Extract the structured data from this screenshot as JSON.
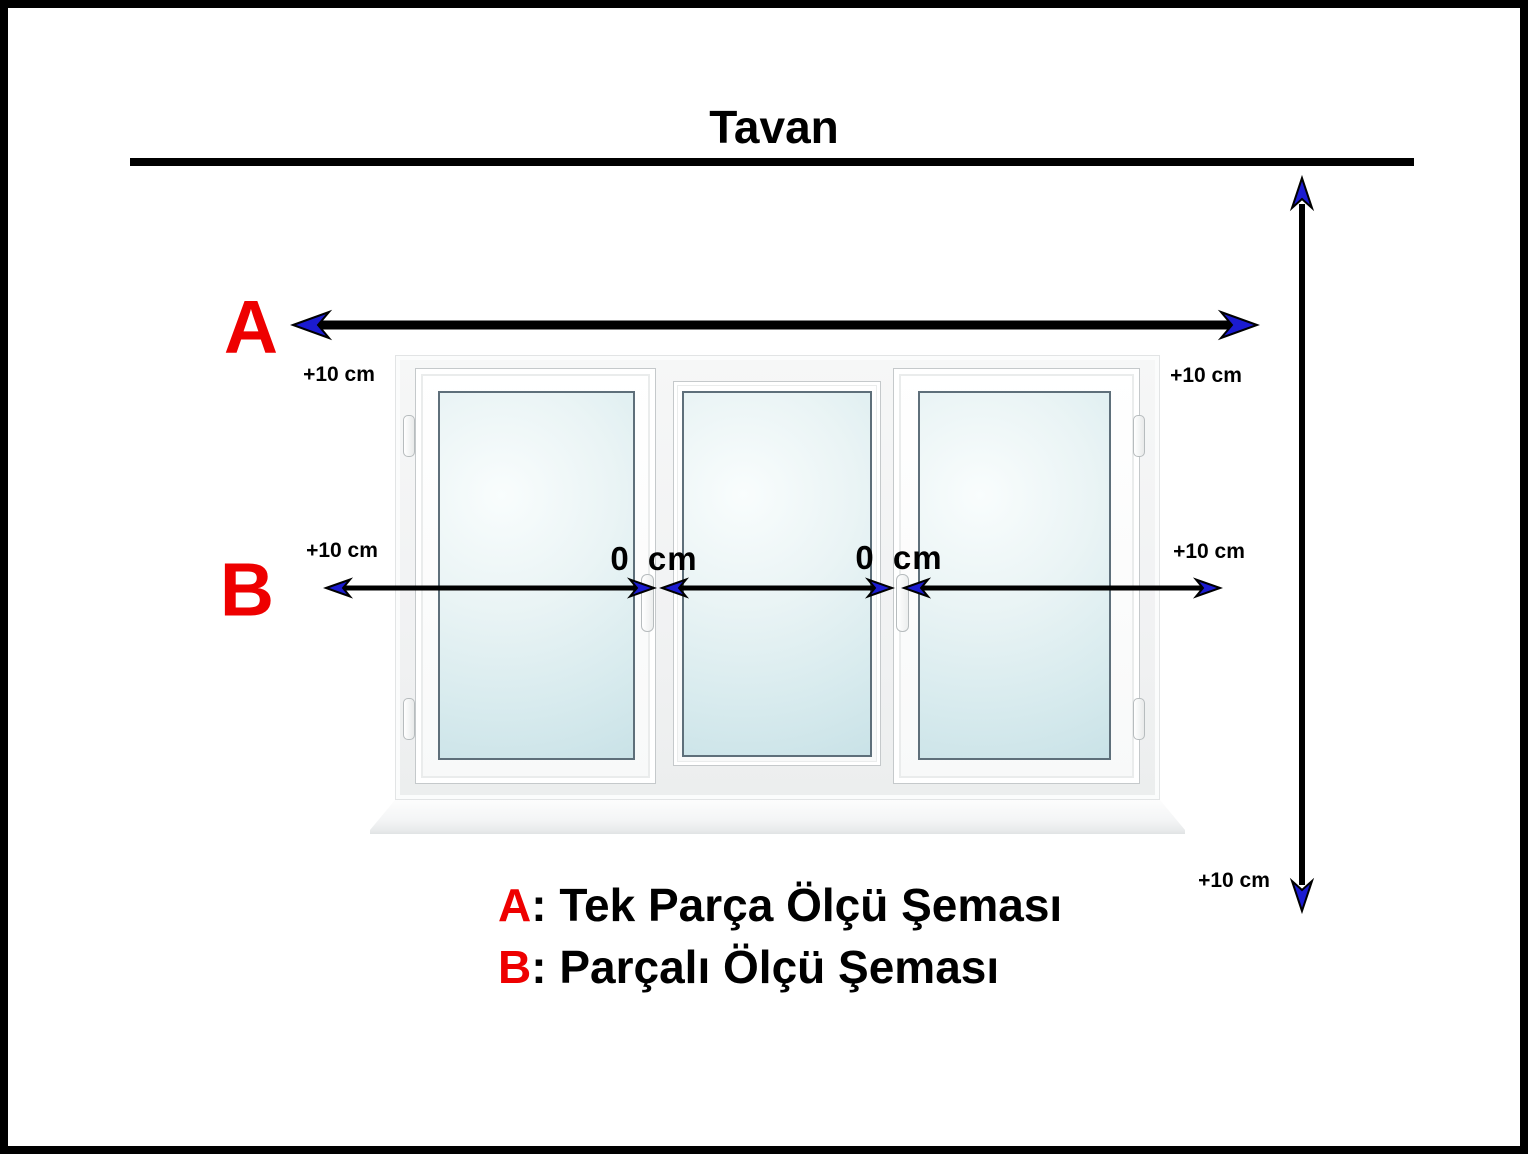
{
  "title": "Tavan",
  "schemas": {
    "a_letter": "A",
    "b_letter": "B"
  },
  "measurements": {
    "offset_label": "+10 cm",
    "gap_label": "0 cm"
  },
  "legend": {
    "a_key": "A",
    "a_text": ": Tek Parça Ölçü Şeması",
    "b_key": "B",
    "b_text": ": Parçalı Ölçü Şeması"
  },
  "colors": {
    "accent_red": "#ee0000",
    "arrow_blue": "#1b1bd0",
    "line_black": "#000000"
  }
}
